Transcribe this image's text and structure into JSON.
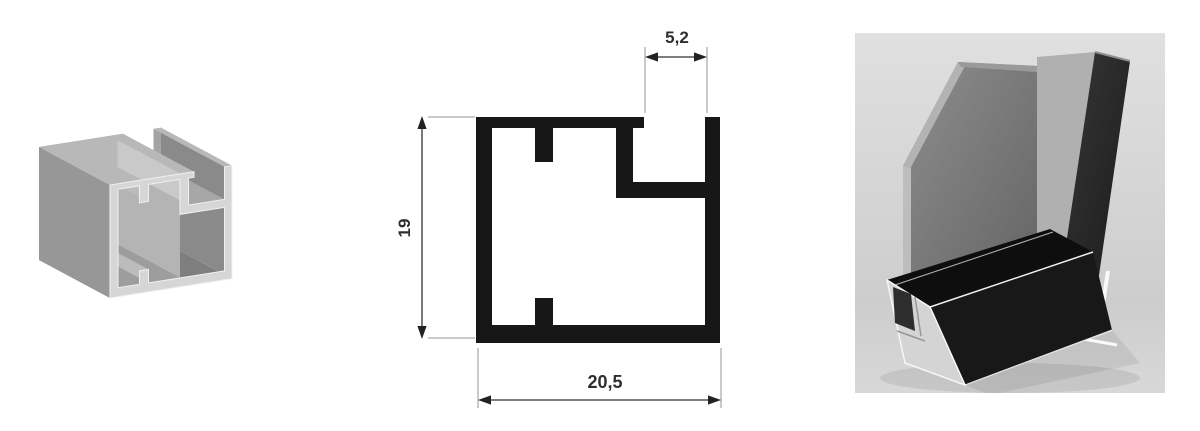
{
  "drawing": {
    "dim_slot_width": "5,2",
    "dim_height": "19",
    "dim_width": "20,5"
  },
  "colors": {
    "ink": "#171717",
    "label": "#2e2e2e",
    "metal_cut_face": "#d6d6d6",
    "metal_top": "#b8b8b8",
    "metal_side": "#979797",
    "metal_back": "#a4a4a4",
    "photo_glass": "#7d7d7d",
    "photo_frame_black": "#181818",
    "photo_background": "#d6d6d6"
  }
}
